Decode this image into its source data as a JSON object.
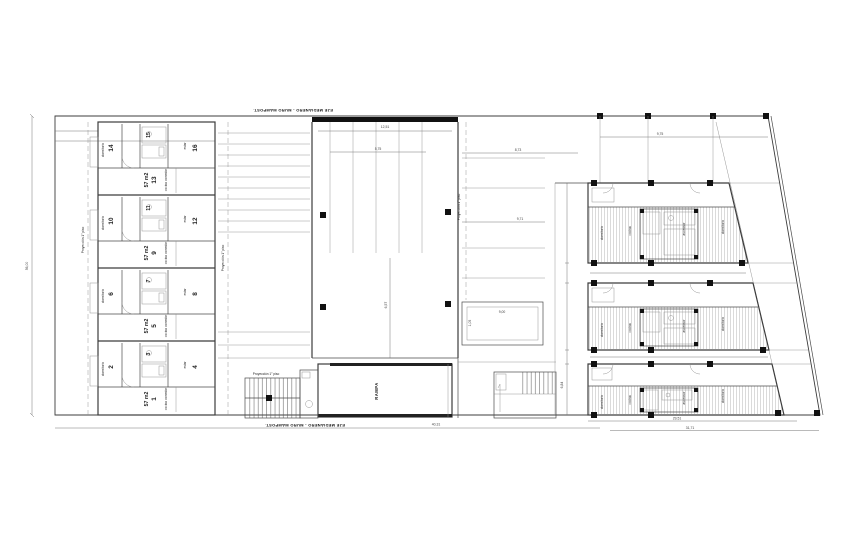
{
  "title": "planta baja - conjunto de viviendas",
  "colors": {
    "line": "#3c3c3c",
    "thin": "#8c8c8c",
    "black": "#111111",
    "hatch": "#b4b4b4",
    "background": "#ffffff"
  },
  "labels": {
    "eje": "EJE MEDIANERO - MURO MAMPOST.",
    "proyeccion": "Proyección 1° piso",
    "rampa": "RAMPA"
  },
  "left_block": {
    "area": "57 m2",
    "rooms": {
      "dorm": "dormitorio",
      "estar": "estar",
      "cocina": "cocina comedor"
    },
    "modules": [
      {
        "dorm_no": "14",
        "core_no": "15",
        "estar_no": "16",
        "unit_no": "13"
      },
      {
        "dorm_no": "10",
        "core_no": "11",
        "estar_no": "12",
        "unit_no": "9"
      },
      {
        "dorm_no": "6",
        "core_no": "7",
        "estar_no": "8",
        "unit_no": "5"
      },
      {
        "dorm_no": "2",
        "core_no": "3",
        "estar_no": "4",
        "unit_no": "1"
      }
    ]
  },
  "right_block": {
    "rooms": {
      "dorm": "dormitorio",
      "cocina": "cocina",
      "ascensor": "ascensor"
    }
  },
  "dimensions": {
    "site_height": "56,00",
    "bottom_left": "40,31",
    "bottom_right_upper": "29,51",
    "bottom_right_lower": "31,71",
    "mid_gap": "8,73",
    "top_right": "9,75",
    "garage_top": "12,51",
    "garage_inner": "5,75",
    "garage_depth": "6,57",
    "parking_mid": "9,71",
    "patio_width": "9,00",
    "patio_left": "1,05",
    "right_strip": "6,84"
  }
}
